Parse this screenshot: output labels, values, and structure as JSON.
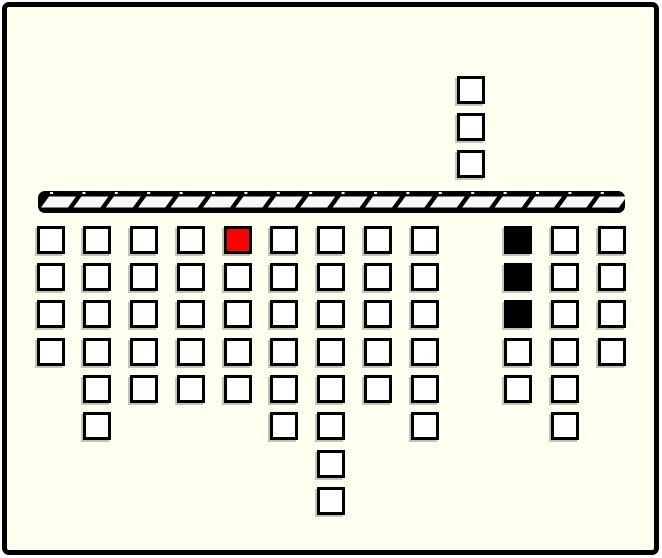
{
  "scene": {
    "page_background": "#FFFFFF",
    "board_background": "#FFFFF0",
    "frame_border_color": "#000000"
  },
  "bar": {
    "segment_count": 18,
    "bar_color": "#000000",
    "segment_color": "#F8F8F4",
    "notch_color": "#FFFFFF"
  },
  "block_colors": {
    "W": "#FFFFFF",
    "R": "#FF0000",
    "B": "#000000"
  },
  "block_names": {
    "W": "white-block",
    "R": "red-block",
    "B": "black-block"
  },
  "board": {
    "columns": [
      {
        "col": 1,
        "below": [
          "W",
          "W",
          "W",
          "W"
        ],
        "above": []
      },
      {
        "col": 2,
        "below": [
          "W",
          "W",
          "W",
          "W",
          "W",
          "W"
        ],
        "above": []
      },
      {
        "col": 3,
        "below": [
          "W",
          "W",
          "W",
          "W",
          "W"
        ],
        "above": []
      },
      {
        "col": 4,
        "below": [
          "W",
          "W",
          "W",
          "W",
          "W"
        ],
        "above": []
      },
      {
        "col": 5,
        "below": [
          "R",
          "W",
          "W",
          "W",
          "W"
        ],
        "above": []
      },
      {
        "col": 6,
        "below": [
          "W",
          "W",
          "W",
          "W",
          "W",
          "W"
        ],
        "above": []
      },
      {
        "col": 7,
        "below": [
          "W",
          "W",
          "W",
          "W",
          "W",
          "W",
          "W",
          "W"
        ],
        "above": []
      },
      {
        "col": 8,
        "below": [
          "W",
          "W",
          "W",
          "W",
          "W"
        ],
        "above": []
      },
      {
        "col": 9,
        "below": [
          "W",
          "W",
          "W",
          "W",
          "W",
          "W"
        ],
        "above": []
      },
      {
        "col": 10,
        "below": [],
        "above": [
          "W",
          "W",
          "W"
        ]
      },
      {
        "col": 11,
        "below": [
          "B",
          "B",
          "B",
          "W",
          "W"
        ],
        "above": []
      },
      {
        "col": 12,
        "below": [
          "W",
          "W",
          "W",
          "W",
          "W",
          "W"
        ],
        "above": []
      },
      {
        "col": 13,
        "below": [
          "W",
          "W",
          "W",
          "W"
        ],
        "above": []
      }
    ]
  }
}
